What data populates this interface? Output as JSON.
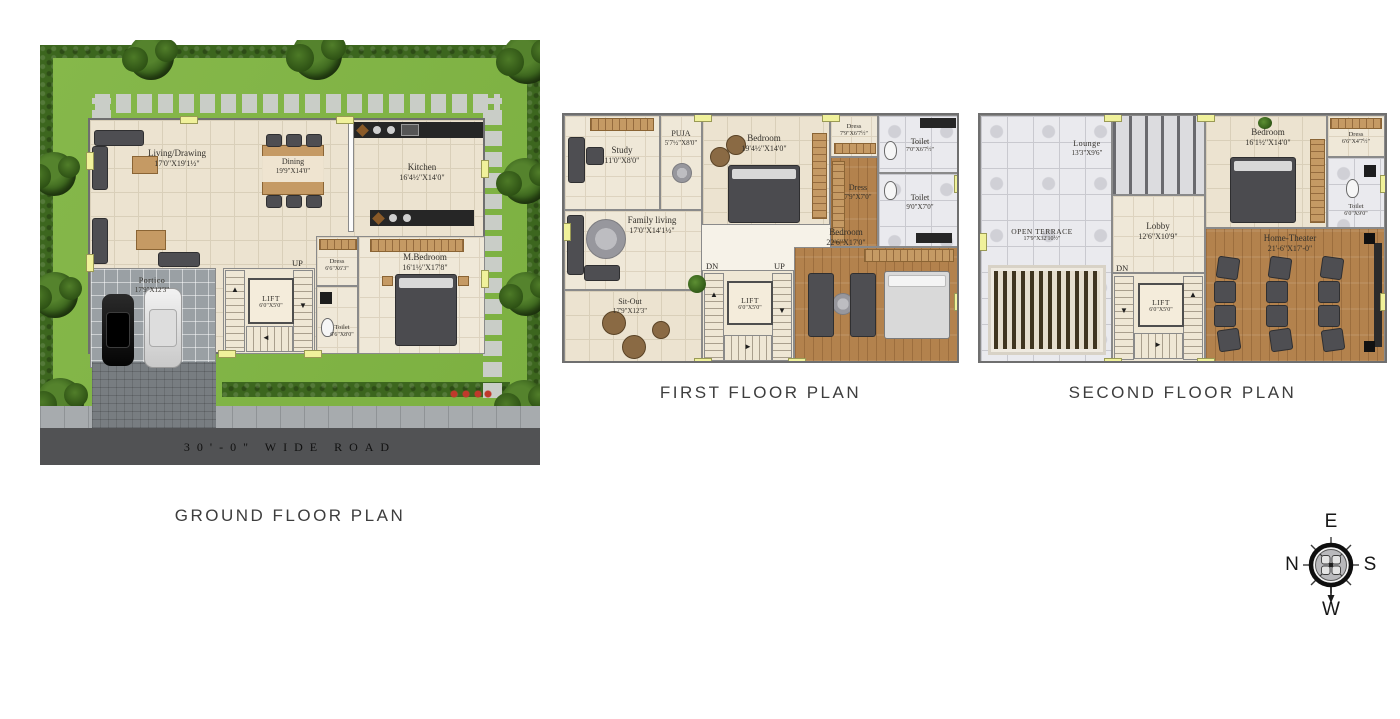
{
  "titles": {
    "ground": "GROUND FLOOR PLAN",
    "first": "FIRST FLOOR PLAN",
    "second": "SECOND FLOOR PLAN"
  },
  "compass": {
    "north": "N",
    "east": "E",
    "south": "S",
    "west": "W"
  },
  "ground": {
    "road": "30'-0\"  WIDE ROAD",
    "living": {
      "name": "Living/Drawing",
      "dims": "17'0\"X19'1½\""
    },
    "dining": {
      "name": "Dining",
      "dims": "19'9\"X14'0\""
    },
    "kitchen": {
      "name": "Kitchen",
      "dims": "16'4½\"X14'0\""
    },
    "portico": {
      "name": "Portico",
      "dims": "17'9\"X12'3\""
    },
    "mbedroom": {
      "name": "M.Bedroom",
      "dims": "16'1½\"X17'8\""
    },
    "dress": {
      "name": "Dress",
      "dims": "6'6\"X6'3\""
    },
    "toilet": {
      "name": "Toilet",
      "dims": "6'6\"X8'0\""
    },
    "lift": {
      "name": "LIFT",
      "dims": "6'0\"X5'0\""
    },
    "up": "UP"
  },
  "first": {
    "study": {
      "name": "Study",
      "dims": "11'0\"X8'0\""
    },
    "puja": {
      "name": "PUJA",
      "dims": "5'7½\"X8'0\""
    },
    "bedroom1": {
      "name": "Bedroom",
      "dims": "19'4½\"X14'0\""
    },
    "dress1": {
      "name": "Dress",
      "dims": "7'9\"X6'7½\""
    },
    "toilet1": {
      "name": "Toilet",
      "dims": "7'0\"X6'7½\""
    },
    "dress2": {
      "name": "Dress",
      "dims": "7'9\"X7'0\""
    },
    "toilet2": {
      "name": "Toilet",
      "dims": "9'0\"X7'0\""
    },
    "family": {
      "name": "Family living",
      "dims": "17'0\"X14'1½\""
    },
    "bedroom2": {
      "name": "Bedroom",
      "dims": "22'6\"X17'0\""
    },
    "sitout": {
      "name": "Sit-Out",
      "dims": "17'9\"X12'3\""
    },
    "lift": {
      "name": "LIFT",
      "dims": "6'0\"X5'0\""
    },
    "dn": "DN",
    "up": "UP"
  },
  "second": {
    "lounge": {
      "name": "Lounge",
      "dims": "13'3\"X9'6\""
    },
    "terrace": {
      "name": "OPEN TERRACE",
      "dims": "17'9\"X32'10½\""
    },
    "lobby": {
      "name": "Lobby",
      "dims": "12'6\"X10'9\""
    },
    "bedroom": {
      "name": "Bedroom",
      "dims": "16'1½\"X14'0\""
    },
    "dress": {
      "name": "Dress",
      "dims": "6'6\"X4'7½\""
    },
    "toilet": {
      "name": "Toilet",
      "dims": "6'0\"X9'0\""
    },
    "theater": {
      "name": "Home-Theater",
      "dims": "21'-6\"X17'-0\""
    },
    "lift": {
      "name": "LIFT",
      "dims": "6'0\"X5'0\""
    },
    "dn": "DN"
  }
}
